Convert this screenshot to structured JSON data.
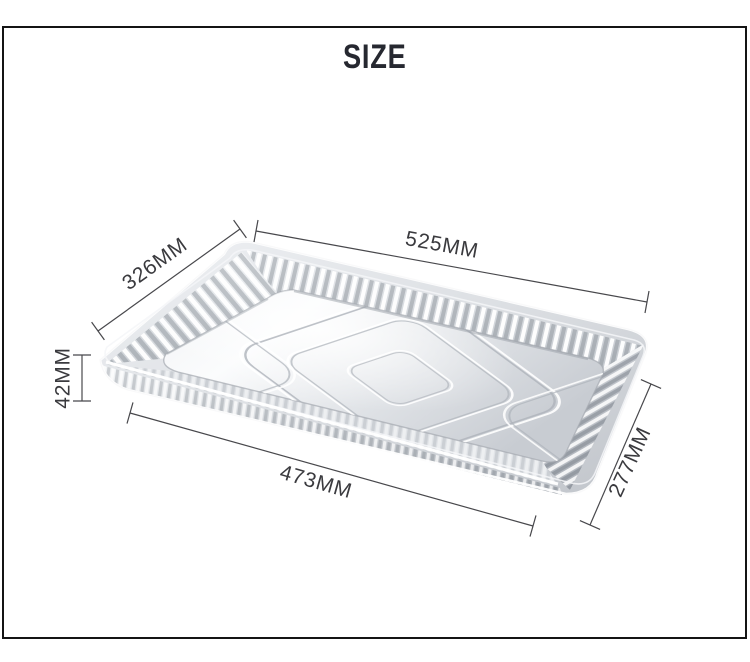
{
  "page": {
    "title": "SIZE",
    "background_color": "#ffffff",
    "frame_border_color": "#141414"
  },
  "product": {
    "name": "rectangular aluminum foil tray",
    "finish_colors": {
      "highlight": "#fbfcfd",
      "base_silver": "#d7dadf",
      "shadow_silver": "#aeb3ba"
    }
  },
  "annotations": {
    "line_color": "#48484c",
    "label_color": "#3a3a3e",
    "dimensions": [
      {
        "id": "top-rim-length",
        "label": "525MM"
      },
      {
        "id": "left-rim-width",
        "label": "326MM"
      },
      {
        "id": "depth",
        "label": "42MM"
      },
      {
        "id": "bottom-base-length",
        "label": "473MM"
      },
      {
        "id": "right-base-width",
        "label": "277MM"
      }
    ]
  }
}
